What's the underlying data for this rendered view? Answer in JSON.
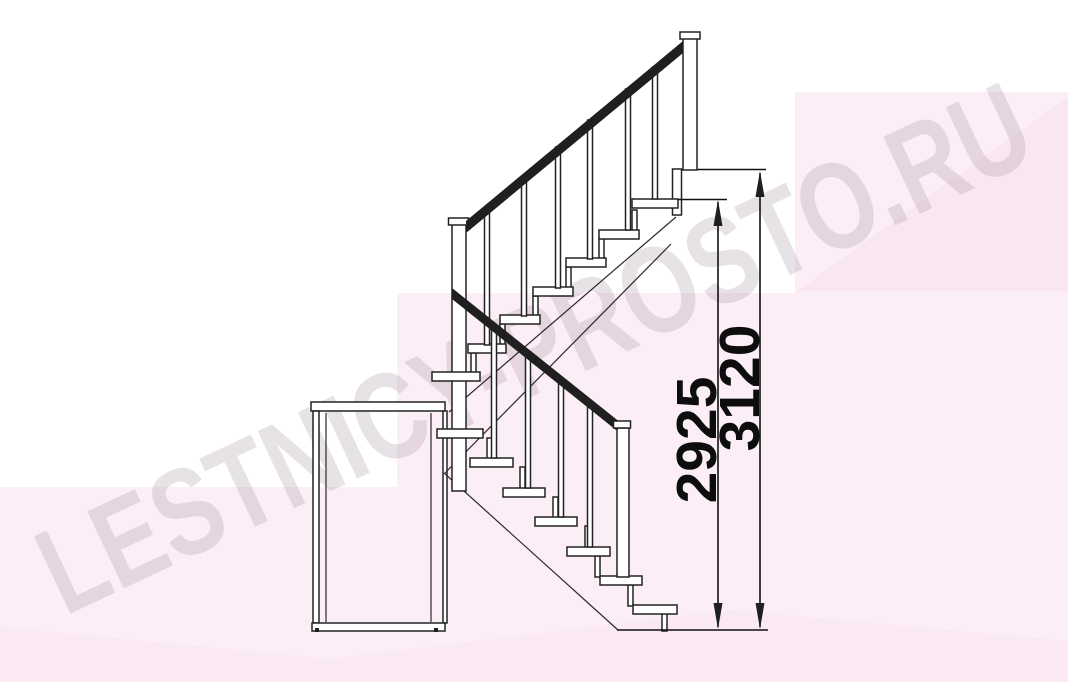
{
  "watermark": {
    "text": "LESTNICY-PROSTO.RU",
    "color": "#a898a5"
  },
  "dimensions": {
    "floor_to_top_step": {
      "value": "2925"
    },
    "floor_to_landing": {
      "value": "3120"
    }
  },
  "drawing": {
    "type": "staircase-side-elevation",
    "upper_flight_treads": 7,
    "lower_flight_treads": 7,
    "line_color": "#222222",
    "handrail_color": "#1f1f1f",
    "background_accent_light": "#fceef6",
    "background_accent_deep": "#f8e3ee"
  }
}
